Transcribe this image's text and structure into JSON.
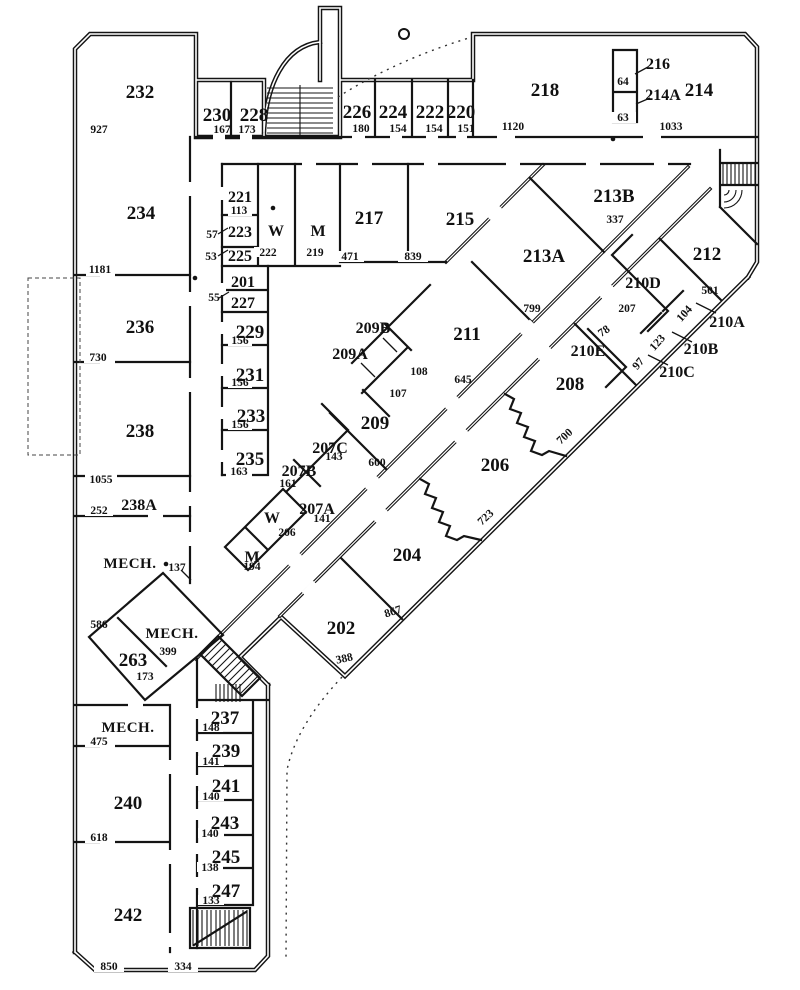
{
  "plan": {
    "ink": "#141414",
    "paper": "#ffffff",
    "kind": "building floor plan, second level"
  },
  "rooms": {
    "r232": "232",
    "r230": "230",
    "r228": "228",
    "r226": "226",
    "r224": "224",
    "r222": "222",
    "r220": "220",
    "r218": "218",
    "r216": "216",
    "r214a": "214A",
    "r214": "214",
    "r234": "234",
    "r221": "221",
    "r223": "223",
    "r225": "225",
    "wtop": "W",
    "mtop": "M",
    "r217": "217",
    "r215": "215",
    "r213b": "213B",
    "r213a": "213A",
    "r212": "212",
    "r210d": "210D",
    "r210a": "210A",
    "r210b": "210B",
    "r210c": "210C",
    "r210e": "210E",
    "r208": "208",
    "r211": "211",
    "r209b": "209B",
    "r209a": "209A",
    "r209": "209",
    "r236": "236",
    "r201": "201",
    "r227": "227",
    "r229": "229",
    "r231": "231",
    "r233": "233",
    "r235": "235",
    "r207c": "207C",
    "r207b": "207B",
    "r207a": "207A",
    "wmid": "W",
    "mmid": "M",
    "r206": "206",
    "r204": "204",
    "r202": "202",
    "r238": "238",
    "r238a": "238A",
    "mech1": "MECH.",
    "mech2": "MECH.",
    "r263": "263",
    "mech3": "MECH.",
    "r240": "240",
    "r242": "242",
    "r237": "237",
    "r239": "239",
    "r241": "241",
    "r243": "243",
    "r245": "245",
    "r247": "247"
  },
  "dims": {
    "d927": "927",
    "d167": "167",
    "d173a": "173",
    "d180": "180",
    "d154a": "154",
    "d154b": "154",
    "d151": "151",
    "d1120": "1120",
    "d64": "64",
    "d63": "63",
    "d1033": "1033",
    "d113": "113",
    "d57": "57",
    "d53": "53",
    "d222": "222",
    "d219": "219",
    "d471": "471",
    "d839": "839",
    "d337": "337",
    "d1181": "1181",
    "d55": "55",
    "d156a": "156",
    "d156b": "156",
    "d156c": "156",
    "d730": "730",
    "d163": "163",
    "d1055": "1055",
    "d252": "252",
    "d137": "137",
    "d586": "586",
    "d399": "399",
    "d173b": "173",
    "d475": "475",
    "d618": "618",
    "d850": "850",
    "d334": "334",
    "d148": "148",
    "d141a": "141",
    "d140a": "140",
    "d140b": "140",
    "d138": "138",
    "d133": "133",
    "d143": "143",
    "d161": "161",
    "d141b": "141",
    "d206": "206",
    "d194": "194",
    "d600": "600",
    "d388": "388",
    "d867": "867",
    "d723": "723",
    "d700": "700",
    "d645": "645",
    "d108": "108",
    "d107": "107",
    "d799": "799",
    "d207": "207",
    "d78": "78",
    "d104": "104",
    "d123": "123",
    "d97": "97",
    "d501": "501"
  }
}
